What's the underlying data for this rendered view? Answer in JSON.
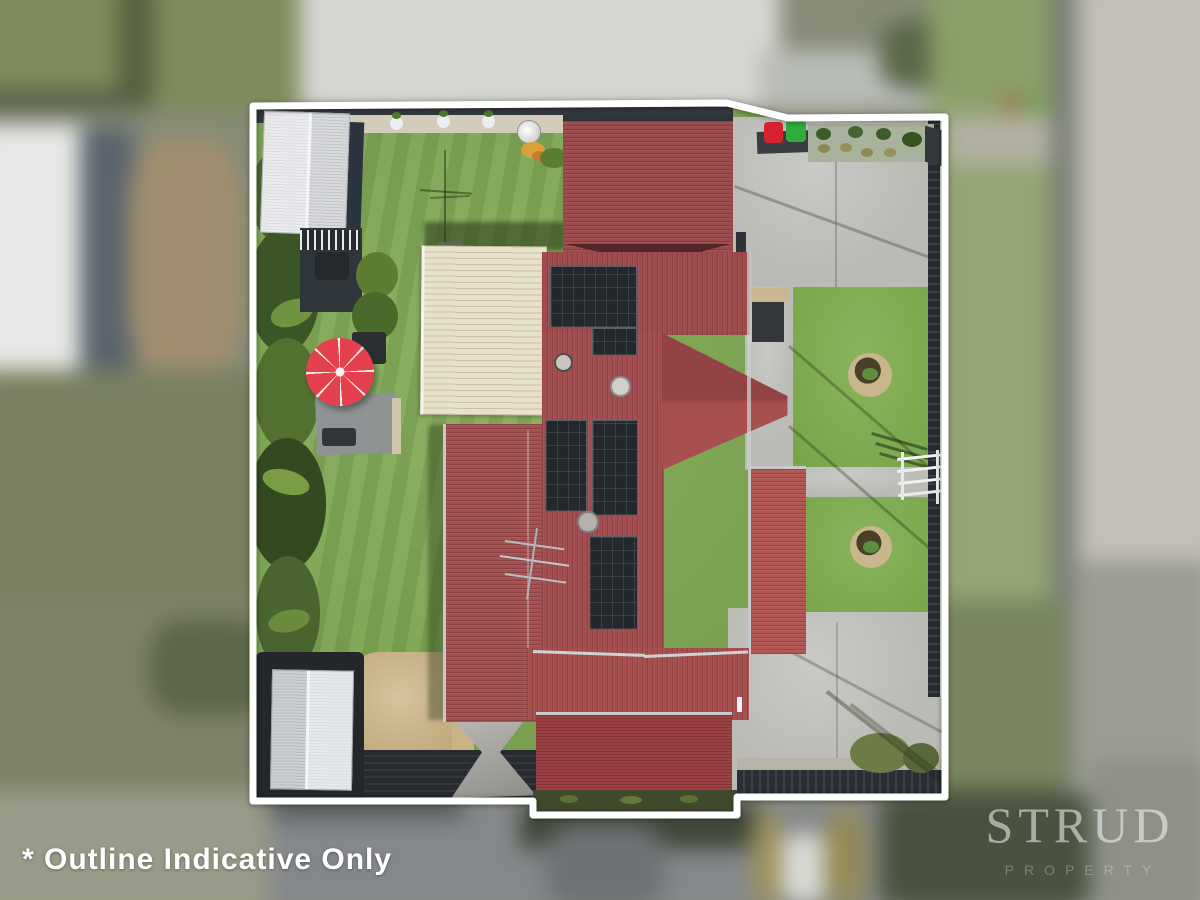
{
  "overlay": {
    "caption": "* Outline Indicative Only"
  },
  "watermark": {
    "brand": "STRUD",
    "tagline": "PROPERTY"
  },
  "colors": {
    "outline_white": "#ffffff",
    "roof_maroon": "#9c4a4d",
    "roof_bright": "#b25654",
    "roof_garage": "#9c4245",
    "pergola_cream": "#e8e1cb",
    "lawn_green": "#79a44a",
    "lawn_right": "#7fae4e",
    "driveway_concrete": "#babbb5",
    "solar_panel": "#23282d",
    "umbrella_red": "#e5404e",
    "bin_red": "#d8232e",
    "bin_green": "#2fae3f",
    "fence_dark": "#2b2f33",
    "sand_tan": "#c9b488",
    "shed_silver": "#d9dadc",
    "foliage_dark": "#3c5527"
  }
}
